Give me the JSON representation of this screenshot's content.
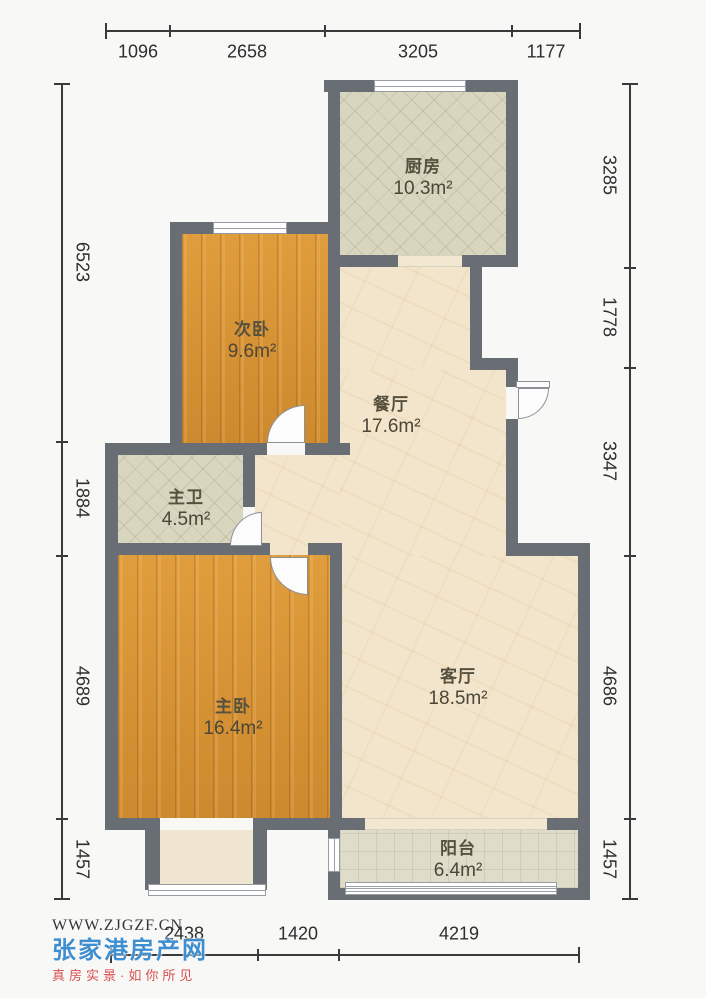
{
  "plan": {
    "title": "two-bedroom apartment floor plan",
    "rooms": [
      {
        "id": "kitchen",
        "name": "厨房",
        "area": "10.3m²"
      },
      {
        "id": "second-bedroom",
        "name": "次卧",
        "area": "9.6m²"
      },
      {
        "id": "dining",
        "name": "餐厅",
        "area": "17.6m²"
      },
      {
        "id": "master-bath",
        "name": "主卫",
        "area": "4.5m²"
      },
      {
        "id": "master-bedroom",
        "name": "主卧",
        "area": "16.4m²"
      },
      {
        "id": "living",
        "name": "客厅",
        "area": "18.5m²"
      },
      {
        "id": "balcony",
        "name": "阳台",
        "area": "6.4m²"
      }
    ],
    "dimensions": {
      "top": [
        "1096",
        "2658",
        "3205",
        "1177"
      ],
      "right": [
        "3285",
        "1778",
        "3347",
        "4686",
        "1457"
      ],
      "left": [
        "6523",
        "1884",
        "4689",
        "1457"
      ],
      "bottom": [
        "2438",
        "1420",
        "4219"
      ]
    },
    "colors": {
      "wall": "#696d74",
      "wood_floor": "#d69233",
      "tile_floor": "#d9d6c0",
      "marble_floor": "#f3e5cb",
      "balcony_floor": "#dfddca"
    }
  },
  "watermark": {
    "url": "WWW.ZJGZF.CN",
    "site_name": "张家港房产网",
    "slogan": "真房实景·如你所见"
  }
}
